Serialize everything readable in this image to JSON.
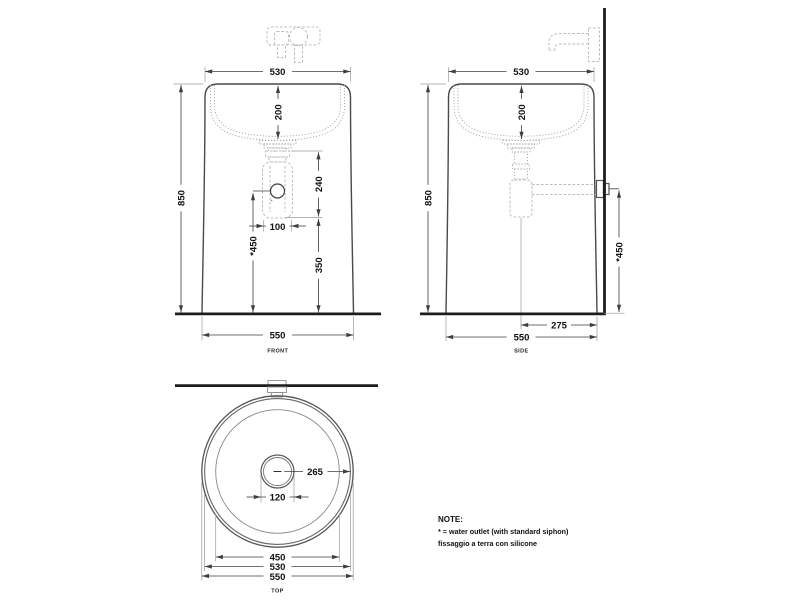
{
  "drawing": {
    "front": {
      "label": "FRONT",
      "dim_top_width": "530",
      "dim_basin_depth": "200",
      "dim_height": "850",
      "dim_siphon_height": "240",
      "dim_outlet_offset": "100",
      "dim_outlet_height": "*450",
      "dim_below_outlet": "350",
      "dim_base_width": "550"
    },
    "side": {
      "label": "SIDE",
      "dim_top_depth": "530",
      "dim_basin_depth": "200",
      "dim_height": "850",
      "dim_outlet_height": "*450",
      "dim_outlet_to_back": "275",
      "dim_base_depth": "550"
    },
    "top": {
      "label": "TOP",
      "dim_center_to_rim": "265",
      "dim_drain_diameter": "120",
      "dim_inner_diameter": "450",
      "dim_rim_diameter": "530",
      "dim_outer_diameter": "550"
    },
    "note": {
      "title": "NOTE:",
      "line1": "* = water outlet (with standard siphon)",
      "line2": "fissaggio a terra con silicone"
    }
  }
}
